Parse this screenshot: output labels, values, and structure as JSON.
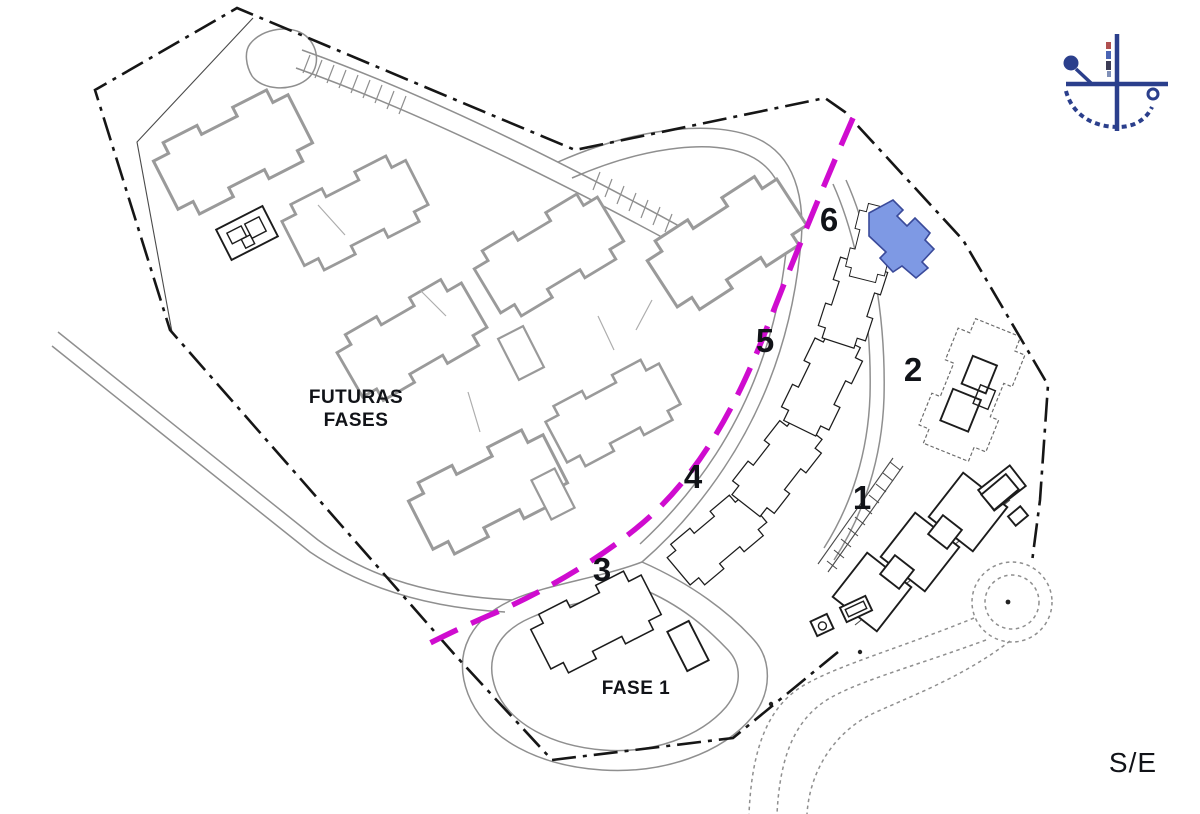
{
  "labels": {
    "future_phases_line1": "FUTURAS",
    "future_phases_line2": "FASES",
    "phase_one": "FASE 1",
    "scale_note": "S/E"
  },
  "blocks": [
    {
      "label": "1"
    },
    {
      "label": "2"
    },
    {
      "label": "3"
    },
    {
      "label": "4"
    },
    {
      "label": "5"
    },
    {
      "label": "6"
    }
  ],
  "colors": {
    "phase_divider": "#cf0ccf",
    "highlight_fill": "#7e99e4",
    "highlight_stroke": "#3a4a9a",
    "boundary": "#161616",
    "future_building": "#9a9a9a",
    "road": "#8f8f8f",
    "building": "#1c1c1c",
    "compass": "#2b3f8c",
    "label": "#111318"
  }
}
